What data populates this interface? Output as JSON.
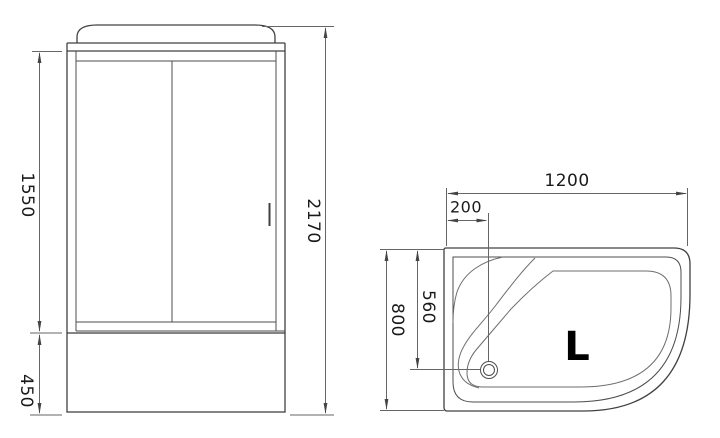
{
  "front_view": {
    "door_height": "1550",
    "base_height": "450",
    "total_height": "2170"
  },
  "top_view": {
    "width": "1200",
    "drain_offset": "200",
    "depth": "800",
    "drain_to_top": "560",
    "orientation": "L"
  },
  "colors": {
    "background": "#ffffff",
    "outline": "#414141",
    "dimension_line": "#666666",
    "text": "#1a1a1a",
    "orientation_text": "#000000"
  }
}
